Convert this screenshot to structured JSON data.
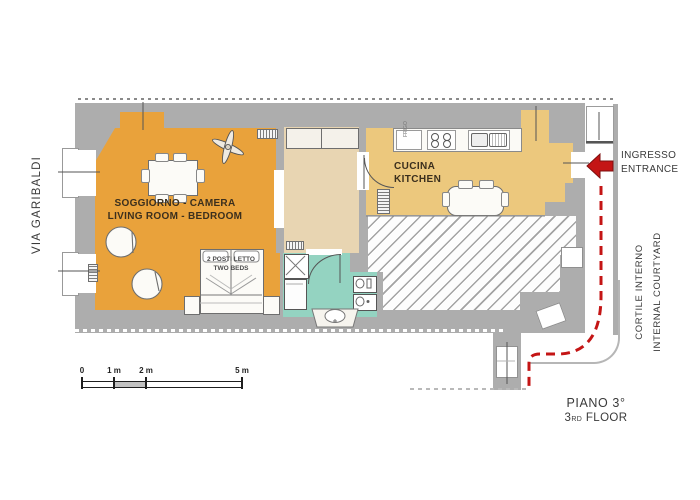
{
  "colors": {
    "wall": "#ADADAD",
    "living": "#E9A23B",
    "hallway": "#E8D5B2",
    "kitchen": "#ECC87D",
    "bath": "#94D3C1",
    "red": "#C41515",
    "ink": "#3B2F1D"
  },
  "labels": {
    "street": "VIA GARIBALDI",
    "living_room": {
      "it": "SOGGIORNO - CAMERA",
      "en": "LIVING ROOM - BEDROOM"
    },
    "beds": {
      "it": "2 POSTI LETTO",
      "en": "TWO BEDS"
    },
    "kitchen": {
      "it": "CUCINA",
      "en": "KITCHEN"
    },
    "entrance": {
      "it": "INGRESSO",
      "en": "ENTRANCE"
    },
    "courtyard": {
      "it": "CORTILE INTERNO",
      "en": "INTERNAL COURTYARD"
    },
    "floor": {
      "it": "PIANO 3°",
      "en_prefix": "3",
      "en_ordinal": "RD",
      "en_suffix": " FLOOR"
    },
    "fridge": "FRIGO"
  },
  "scale_bar": {
    "labels": [
      "0",
      "1 m",
      "2 m",
      "5 m"
    ]
  }
}
